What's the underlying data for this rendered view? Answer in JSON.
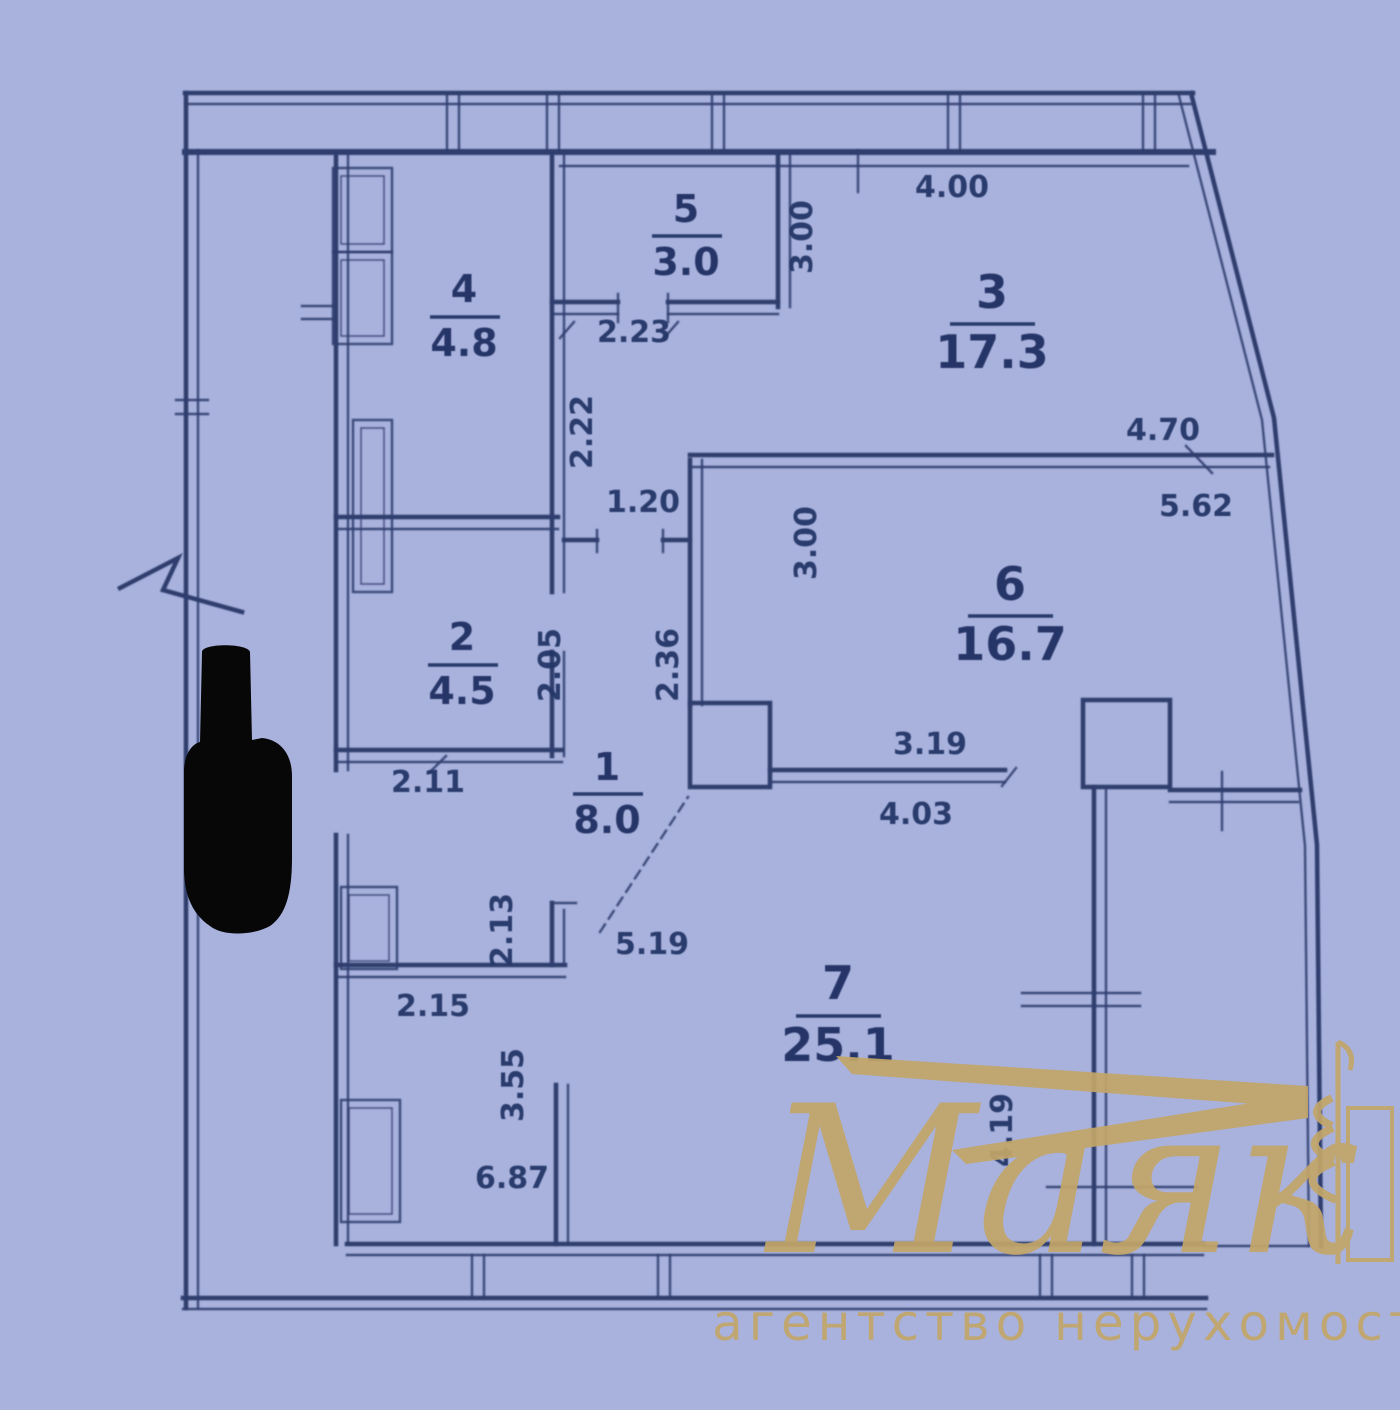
{
  "colors": {
    "bg": "#a9b2dd",
    "line": "#2e3c6d",
    "dim": "#253567",
    "gold": "#c2a568",
    "redact": "#070708"
  },
  "rooms": [
    {
      "number": "4",
      "area": "4.8"
    },
    {
      "number": "5",
      "area": "3.0"
    },
    {
      "number": "3",
      "area": "17.3"
    },
    {
      "number": "2",
      "area": "4.5"
    },
    {
      "number": "6",
      "area": "16.7"
    },
    {
      "number": "1",
      "area": "8.0"
    },
    {
      "number": "7",
      "area": "25.1"
    }
  ],
  "dims": [
    "4.00",
    "3.00",
    "2.23",
    "2.22",
    "1.20",
    "4.70",
    "5.62",
    "3.00",
    "2.05",
    "2.36",
    "2.11",
    "3.19",
    "4.03",
    "5.19",
    "2.13",
    "2.15",
    "3.55",
    "6.87",
    "4.19"
  ],
  "watermark": {
    "title": "Маяк",
    "subtitle": "агентство нерухомості"
  }
}
